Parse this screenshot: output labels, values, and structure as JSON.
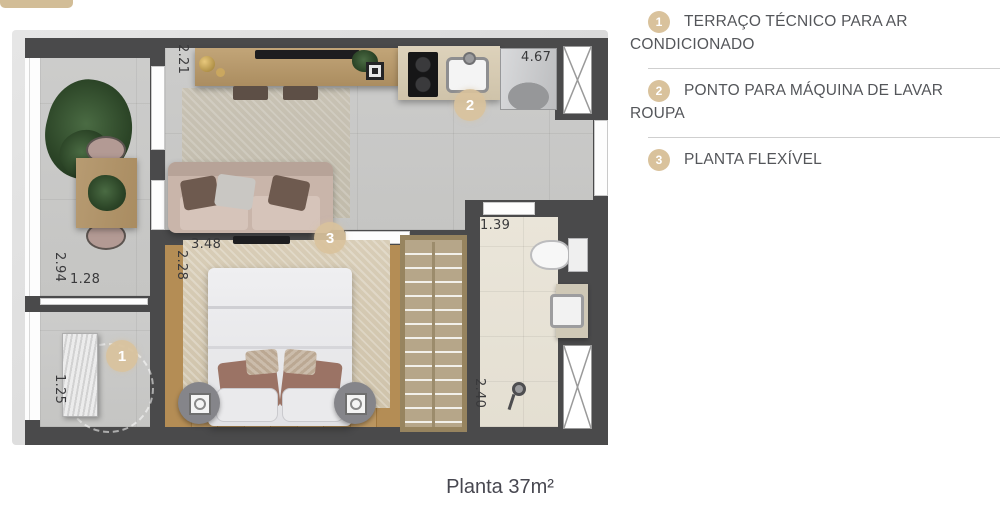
{
  "header": {
    "tab_color": "#d2bd97"
  },
  "legend": {
    "badge_color": "#d9c29c",
    "text_color": "#54565a",
    "items": [
      {
        "number": "1",
        "label": "TERRAÇO TÉCNICO PARA AR CONDICIONADO"
      },
      {
        "number": "2",
        "label": "PONTO PARA MÁQUINA DE LAVAR ROUPA"
      },
      {
        "number": "3",
        "label": "PLANTA FLEXÍVEL"
      }
    ]
  },
  "caption": {
    "text": "Planta 37m²"
  },
  "floor_plan": {
    "markers": [
      {
        "number": "1",
        "location": "technical-terrace"
      },
      {
        "number": "2",
        "location": "kitchen"
      },
      {
        "number": "3",
        "location": "bedroom"
      }
    ],
    "measurements": {
      "living_room_width": "2.21",
      "terrace_length": "2.94",
      "terrace_width": "1.28",
      "technical_terrace_length": "1.25",
      "bedroom_width": "3.48",
      "bedroom_depth": "2.28",
      "kitchen_living_length": "4.67",
      "bathroom_width": "1.39",
      "bathroom_length": "2.40"
    },
    "colors": {
      "wall": "#4a4a4b",
      "marker": "#d9c29c",
      "wood_floor": "#b48d55",
      "concrete_floor": "#c9c9c7",
      "bath_floor": "#e8e3d7"
    }
  }
}
